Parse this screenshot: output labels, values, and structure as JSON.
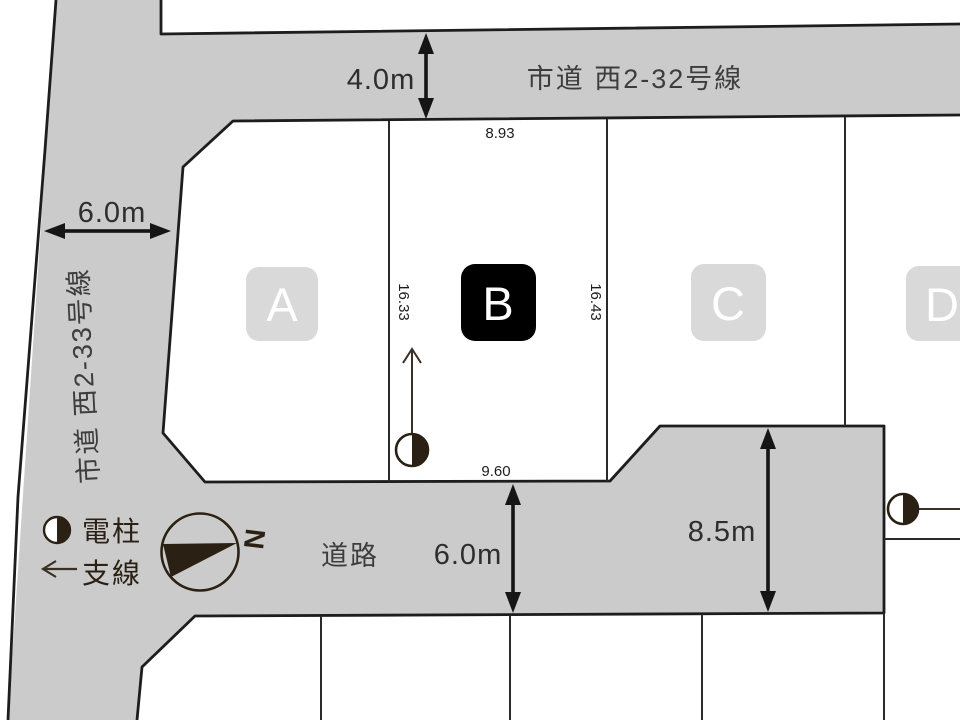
{
  "roads": {
    "top": {
      "name": "市道 西2-32号線",
      "width": "4.0m"
    },
    "left": {
      "name": "市道 西2-33号線",
      "width": "6.0m"
    },
    "bottom": {
      "name": "道路",
      "width": "6.0m"
    },
    "east": {
      "width": "8.5m"
    }
  },
  "plots": [
    {
      "id": "A",
      "selected": false,
      "badge_color": "#d9d9d9",
      "label_color": "#ffffff"
    },
    {
      "id": "B",
      "selected": true,
      "badge_color": "#000000",
      "label_color": "#ffffff"
    },
    {
      "id": "C",
      "selected": false,
      "badge_color": "#d9d9d9",
      "label_color": "#ffffff"
    },
    {
      "id": "D",
      "selected": false,
      "badge_color": "#d9d9d9",
      "label_color": "#ffffff"
    }
  ],
  "dimensions": {
    "plot_b_top": "8.93",
    "plot_b_left": "16.33",
    "plot_b_right": "16.43",
    "plot_b_bottom": "9.60"
  },
  "legend": {
    "utility_pole": "電柱",
    "guy_wire": "支線"
  },
  "compass": {
    "north": "N"
  },
  "colors": {
    "road_fill": "#cbcbcb",
    "outline": "#1d1d1d",
    "dim_color": "#151515",
    "road_text": "#3d3d3d",
    "dim_text": "#1c1c1c",
    "icon": "#2b2014"
  }
}
